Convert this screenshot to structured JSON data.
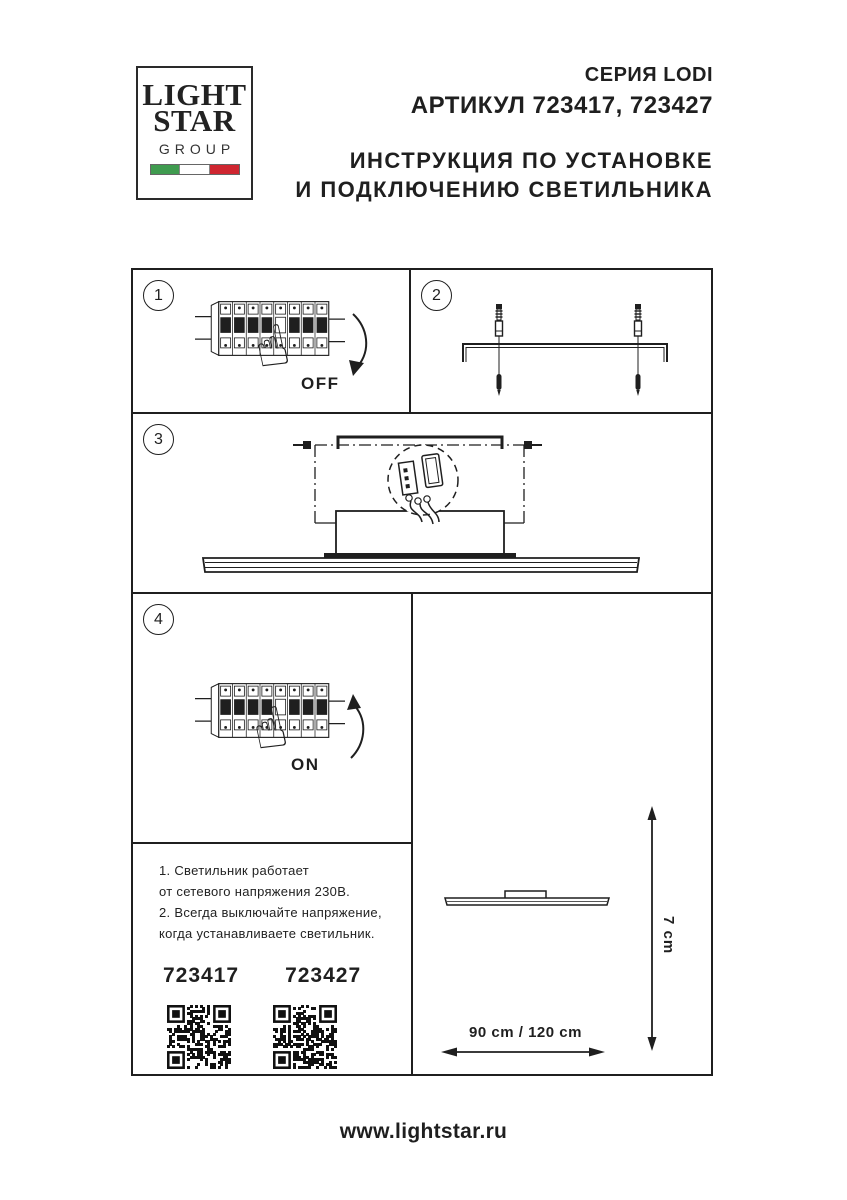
{
  "logo": {
    "word1": "LIGHT",
    "word2": "STAR",
    "word3": "GROUP",
    "flag_colors": [
      "#3f9b4f",
      "#ffffff",
      "#cf2630"
    ]
  },
  "header": {
    "series": "СЕРИЯ LODI",
    "article_line": "АРТИКУЛ 723417, 723427",
    "title_lines": [
      "ИНСТРУКЦИЯ ПО УСТАНОВКЕ",
      "И ПОДКЛЮЧЕНИЮ СВЕТИЛЬНИКА"
    ]
  },
  "steps": [
    {
      "number": "1",
      "label": "OFF"
    },
    {
      "number": "2",
      "label": ""
    },
    {
      "number": "3",
      "label": ""
    },
    {
      "number": "4",
      "label": "ON"
    }
  ],
  "notes": {
    "lines": [
      "1. Светильник работает",
      "от сетевого напряжения 230В.",
      "2. Всегда выключайте напряжение,",
      "когда устанавливаете светильник."
    ],
    "articles": [
      "723417",
      "723427"
    ]
  },
  "dimensions": {
    "height_label": "7 cm",
    "width_label": "90 cm / 120 cm"
  },
  "icons": {
    "hand_pointing": "☝"
  },
  "footer": {
    "url": "www.lightstar.ru"
  },
  "colors": {
    "ink": "#1f1f1f",
    "paper": "#ffffff"
  }
}
